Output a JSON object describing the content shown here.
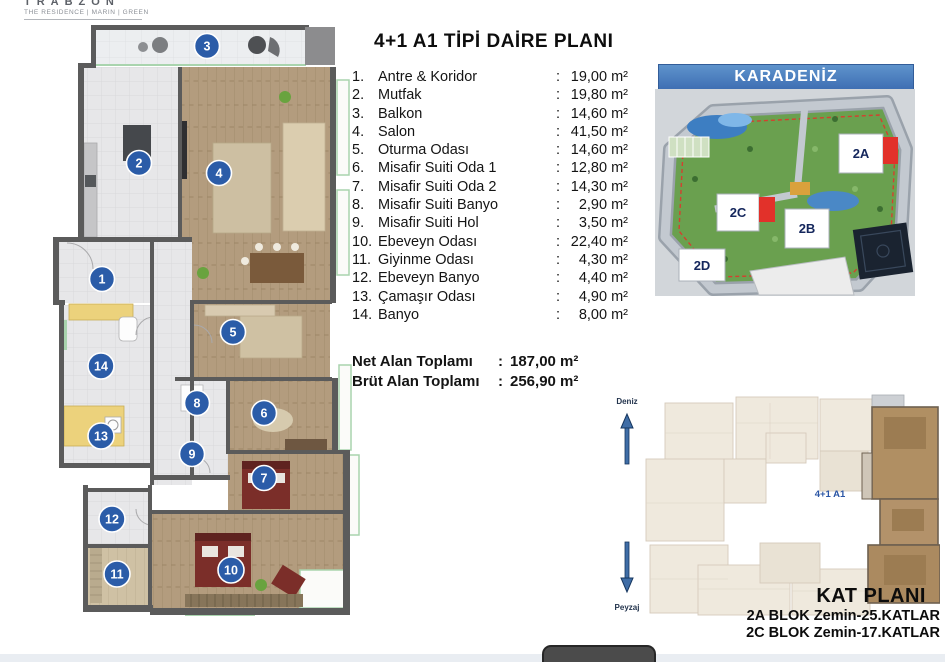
{
  "logo": {
    "brand": "TRABZON",
    "tagline": "THE RESIDENCE | MARIN | GREEN"
  },
  "title": "4+1 A1 TİPİ DAİRE PLANI",
  "room_list": {
    "sep": ":",
    "rooms": [
      {
        "num": "1.",
        "name": "Antre & Koridor",
        "area": "19,00 m²"
      },
      {
        "num": "2.",
        "name": "Mutfak",
        "area": "19,80 m²"
      },
      {
        "num": "3.",
        "name": "Balkon",
        "area": "14,60 m²"
      },
      {
        "num": "4.",
        "name": "Salon",
        "area": "41,50 m²"
      },
      {
        "num": "5.",
        "name": "Oturma Odası",
        "area": "14,60 m²"
      },
      {
        "num": "6.",
        "name": "Misafir Suiti Oda 1",
        "area": "12,80 m²"
      },
      {
        "num": "7.",
        "name": "Misafir Suiti Oda 2",
        "area": "14,30 m²"
      },
      {
        "num": "8.",
        "name": "Misafir Suiti Banyo",
        "area": "2,90 m²"
      },
      {
        "num": "9.",
        "name": "Misafir Suiti Hol",
        "area": "3,50 m²"
      },
      {
        "num": "10.",
        "name": "Ebeveyn Odası",
        "area": "22,40 m²"
      },
      {
        "num": "11.",
        "name": "Giyinme Odası",
        "area": "4,30 m²"
      },
      {
        "num": "12.",
        "name": "Ebeveyn Banyo",
        "area": "4,40 m²"
      },
      {
        "num": "13.",
        "name": "Çamaşır Odası",
        "area": "4,90 m²"
      },
      {
        "num": "14.",
        "name": "Banyo",
        "area": "8,00 m²"
      }
    ]
  },
  "totals": {
    "net_label": "Net Alan Toplamı",
    "net_value": "187,00 m²",
    "brut_label": "Brüt Alan Toplamı",
    "brut_value": "256,90 m²",
    "sep": ":"
  },
  "site_plan": {
    "header": "KARADENİZ",
    "block_2a": "2A",
    "block_2b": "2B",
    "block_2c": "2C",
    "block_2d": "2D"
  },
  "kat_plan": {
    "unit_label": "4+1 A1",
    "title": "KAT PLANI",
    "line1": "2A BLOK Zemin-25.KATLAR",
    "line2": "2C BLOK Zemin-17.KATLAR",
    "sea_label": "Deniz",
    "landscape_label": "Peyzaj"
  },
  "floor_plan": {
    "markers": [
      "1",
      "2",
      "3",
      "4",
      "5",
      "6",
      "7",
      "8",
      "9",
      "10",
      "11",
      "12",
      "13",
      "14"
    ]
  },
  "colors": {
    "marker_blue": "#2b5ca8",
    "site_header_blue": "#4a7fc0",
    "highlight_red": "#e2312a",
    "unit_label_blue": "#2a55a5",
    "wall_gray": "#5b5b5b",
    "wood_floor": "#b29b7d"
  }
}
